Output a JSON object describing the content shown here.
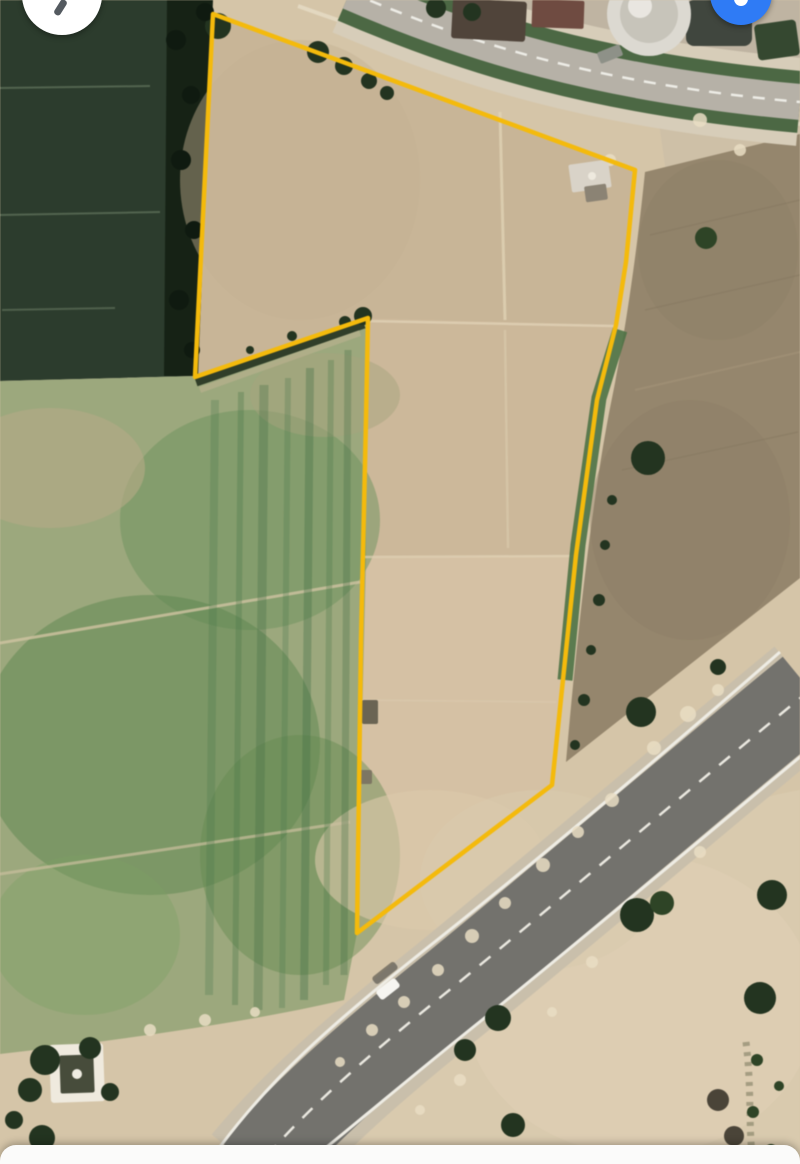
{
  "app": {
    "name": "satellite-map-parcel-view"
  },
  "controls": {
    "compass_button": {
      "bg": "#ffffff",
      "needle_color": "#545a60"
    },
    "location_button": {
      "bg": "#2f7bf5",
      "glyph_color": "#ffffff"
    },
    "bottom_sheet": {
      "bg": "#fbfbfa"
    }
  },
  "map": {
    "parcel": {
      "stroke": "#F4BA0C",
      "stroke_width": 4.5,
      "points": "213,14 635,170 626,262 616,325 597,400 576,555 552,785 357,933 361,640 366,420 368,318 195,377"
    },
    "highway": {
      "shoulder_color": "#c9bfab",
      "shoulder_width": 112,
      "asphalt_color": "#73726d",
      "asphalt_width": 86,
      "line_color": "#eeece4",
      "dash_color": "#eae8e0",
      "centerline_d": "M810,690 C700,780 566,895 452,988 C362,1060 300,1115 255,1170",
      "edge_upper_d": "M780,652 C670,748 536,862 422,952 C332,1024 268,1080 214,1155",
      "edge_lower_d": "M842,722 C730,815 596,928 482,1020 C392,1092 332,1144 298,1170"
    },
    "vehicle": {
      "cx": 388,
      "cy": 989,
      "w": 24,
      "h": 11,
      "angle": -38,
      "color": "#f6f5f1",
      "shadow_cx": 384,
      "shadow_cy": 975,
      "shadow_color": "#3c3c38"
    },
    "regions": [
      {
        "name": "base-sand",
        "d": "M0,0H800V1164H0Z",
        "fill": "#d5c5a8",
        "op": 1
      },
      {
        "name": "parcel-soil",
        "d": "M213,14L635,170L626,262L616,325L597,400L576,555L552,785L357,933L361,640L366,420L368,318L195,377Z",
        "fill": "#ccb89a",
        "op": 1
      },
      {
        "name": "parcel-top-block",
        "d": "M213,14L635,170L616,325L368,318L195,377Z",
        "fill": "#c7b496",
        "op": 0.85
      },
      {
        "name": "parcel-low-block",
        "d": "M363,558L576,555L552,785L357,933Z",
        "fill": "#d6c2a5",
        "op": 0.9
      },
      {
        "name": "dark-green-field",
        "d": "M0,0L207,0L196,376L0,381Z",
        "fill": "#2c3c2d",
        "op": 1
      },
      {
        "name": "tree-line",
        "d": "M167,0L213,0L198,376L164,376Z",
        "fill": "#162215",
        "op": 1
      },
      {
        "name": "left-farmland",
        "d": "M0,381L196,376L366,318L366,560L357,933L344,1000C250,1022 120,1040 0,1054Z",
        "fill": "#9ca87d",
        "op": 1
      },
      {
        "name": "buildings-zone",
        "d": "M390,0L800,0L800,90C640,72 510,38 390,0Z",
        "fill": "#bfb4a2",
        "op": 1
      },
      {
        "name": "right-sand-upper",
        "d": "M655,95L800,90L800,140L666,172Z",
        "fill": "#cec0a7",
        "op": 1
      },
      {
        "name": "brown-field",
        "d": "M645,172L800,134L800,578L566,762C580,600 596,478 611,403C623,345 636,262 645,172Z",
        "fill": "#95866d",
        "op": 1
      },
      {
        "name": "bottom-right-sand",
        "d": "M800,790L800,1164H330C420,1060 560,930 680,840C730,805 770,795 800,790Z",
        "fill": "#d9caae",
        "op": 1
      }
    ],
    "patches": [
      {
        "name": "farm-green-1",
        "cx": 250,
        "cy": 520,
        "rx": 130,
        "ry": 110,
        "fill": "#6c915d",
        "op": 0.5
      },
      {
        "name": "farm-green-2",
        "cx": 150,
        "cy": 745,
        "rx": 170,
        "ry": 150,
        "fill": "#5c864f",
        "op": 0.5
      },
      {
        "name": "farm-green-3",
        "cx": 300,
        "cy": 855,
        "rx": 100,
        "ry": 120,
        "fill": "#63894f",
        "op": 0.45
      },
      {
        "name": "farm-green-4",
        "cx": 85,
        "cy": 935,
        "rx": 95,
        "ry": 80,
        "fill": "#7da063",
        "op": 0.4
      },
      {
        "name": "farm-tan-1",
        "cx": 50,
        "cy": 468,
        "rx": 95,
        "ry": 60,
        "fill": "#b5aa87",
        "op": 0.6
      },
      {
        "name": "farm-tan-2",
        "cx": 325,
        "cy": 395,
        "rx": 75,
        "ry": 42,
        "fill": "#a5a47d",
        "op": 0.5
      },
      {
        "name": "parcel-gray-wash",
        "cx": 300,
        "cy": 180,
        "rx": 120,
        "ry": 140,
        "fill": "#c4b193",
        "op": 0.45
      },
      {
        "name": "parcel-light-wash",
        "cx": 430,
        "cy": 860,
        "rx": 115,
        "ry": 70,
        "fill": "#dccaab",
        "op": 0.6
      },
      {
        "name": "sand-light-1",
        "cx": 640,
        "cy": 1005,
        "rx": 175,
        "ry": 150,
        "fill": "#decfb4",
        "op": 0.7
      },
      {
        "name": "sand-light-2",
        "cx": 540,
        "cy": 880,
        "rx": 120,
        "ry": 90,
        "fill": "#d9c9ad",
        "op": 0.6
      },
      {
        "name": "brown-shade-1",
        "cx": 718,
        "cy": 250,
        "rx": 80,
        "ry": 90,
        "fill": "#8e8067",
        "op": 0.5
      },
      {
        "name": "brown-shade-2",
        "cx": 690,
        "cy": 520,
        "rx": 100,
        "ry": 120,
        "fill": "#8c7e66",
        "op": 0.4
      }
    ],
    "strokes": [
      {
        "name": "notch-shadow",
        "d": "M196,382L364,324",
        "stroke": "#1d2b1a",
        "w": 9,
        "op": 0.85
      },
      {
        "name": "notch-margin",
        "d": "M200,390L360,333",
        "stroke": "#c2b394",
        "w": 6,
        "op": 0.5
      },
      {
        "name": "farm-track-1",
        "d": "M0,643L360,582",
        "stroke": "#cfc3a1",
        "w": 3,
        "op": 0.8
      },
      {
        "name": "farm-track-2",
        "d": "M0,874L350,822",
        "stroke": "#cbbf9e",
        "w": 3,
        "op": 0.7
      },
      {
        "name": "farm-stripe-1",
        "d": "M215,400L209,995",
        "stroke": "#48764a",
        "w": 8,
        "op": 0.28
      },
      {
        "name": "farm-stripe-2",
        "d": "M241,392L235,1005",
        "stroke": "#48764a",
        "w": 6,
        "op": 0.33
      },
      {
        "name": "farm-stripe-3",
        "d": "M264,385L258,1010",
        "stroke": "#3f6b42",
        "w": 9,
        "op": 0.3
      },
      {
        "name": "farm-stripe-4",
        "d": "M288,378L282,1008",
        "stroke": "#48764a",
        "w": 6,
        "op": 0.28
      },
      {
        "name": "farm-stripe-5",
        "d": "M310,368L304,1000",
        "stroke": "#3f6b42",
        "w": 8,
        "op": 0.34
      },
      {
        "name": "farm-stripe-6",
        "d": "M331,360L326,985",
        "stroke": "#48764a",
        "w": 6,
        "op": 0.3
      },
      {
        "name": "farm-stripe-7",
        "d": "M348,350L344,975",
        "stroke": "#3f6b42",
        "w": 7,
        "op": 0.3
      },
      {
        "name": "darkfield-line-1",
        "d": "M0,88L150,86",
        "stroke": "#6d7e66",
        "w": 2,
        "op": 0.6
      },
      {
        "name": "darkfield-line-2",
        "d": "M0,215L160,212",
        "stroke": "#6d7e66",
        "w": 2,
        "op": 0.6
      },
      {
        "name": "darkfield-line-3",
        "d": "M2,310L115,308",
        "stroke": "#6d7e66",
        "w": 2,
        "op": 0.55
      },
      {
        "name": "parcel-div-1",
        "d": "M368,321L614,326",
        "stroke": "#e0d1b5",
        "w": 2.5,
        "op": 0.8
      },
      {
        "name": "parcel-div-2",
        "d": "M363,557L574,556",
        "stroke": "#e0d1b5",
        "w": 2.5,
        "op": 0.7
      },
      {
        "name": "parcel-div-3",
        "d": "M360,700L556,702",
        "stroke": "#dbcbaf",
        "w": 2,
        "op": 0.5
      },
      {
        "name": "parcel-track-v1",
        "d": "M500,112L505,320",
        "stroke": "#e3d5b8",
        "w": 3,
        "op": 0.7
      },
      {
        "name": "parcel-track-v2",
        "d": "M505,330L508,548",
        "stroke": "#decfb2",
        "w": 2.5,
        "op": 0.5
      },
      {
        "name": "brown-striation-1",
        "d": "M650,235L800,200",
        "stroke": "#857760",
        "w": 1.5,
        "op": 0.5
      },
      {
        "name": "brown-striation-2",
        "d": "M645,310L800,275",
        "stroke": "#857760",
        "w": 1.5,
        "op": 0.5
      },
      {
        "name": "brown-striation-3",
        "d": "M635,390L800,352",
        "stroke": "#a59479",
        "w": 2,
        "op": 0.6
      },
      {
        "name": "brown-striation-4",
        "d": "M622,470L798,432",
        "stroke": "#857760",
        "w": 1.5,
        "op": 0.5
      },
      {
        "name": "top-track-pale",
        "d": "M298,6C440,58 600,96 800,124",
        "stroke": "#e5dac4",
        "w": 4,
        "op": 0.85
      },
      {
        "name": "shrub-line-br",
        "d": "M746,1042C752,1090 748,1125 753,1164",
        "stroke": "#6e6e52",
        "w": 7,
        "op": 0.5,
        "dash": "4 6"
      },
      {
        "name": "road-green-upper",
        "d": "M350,-8 C470,44 600,84 800,102",
        "stroke": "#d7cdb9",
        "w": 88,
        "op": 1
      },
      {
        "name": "road-green",
        "d": "M350,-8 C470,44 600,84 800,102",
        "stroke": "#4c6844",
        "w": 62,
        "op": 1
      },
      {
        "name": "road-surface",
        "d": "M350,-8 C470,44 600,84 800,102",
        "stroke": "#b6b1a7",
        "w": 36,
        "op": 1
      },
      {
        "name": "road-dashes",
        "d": "M350,-8 C470,44 600,84 800,102",
        "stroke": "#f0efe9",
        "w": 2.5,
        "op": 0.95,
        "dash": "12 10"
      },
      {
        "name": "green-strip-parcel-right",
        "d": "M620,330L599,398L578,545L565,680",
        "stroke": "#4e7245",
        "w": 15,
        "op": 0.9
      }
    ],
    "speckles": [
      {
        "cx": 612,
        "cy": 800,
        "r": 7
      },
      {
        "cx": 578,
        "cy": 832,
        "r": 6
      },
      {
        "cx": 543,
        "cy": 865,
        "r": 7
      },
      {
        "cx": 505,
        "cy": 903,
        "r": 6
      },
      {
        "cx": 472,
        "cy": 936,
        "r": 7
      },
      {
        "cx": 438,
        "cy": 970,
        "r": 6
      },
      {
        "cx": 404,
        "cy": 1002,
        "r": 6
      },
      {
        "cx": 688,
        "cy": 714,
        "r": 8
      },
      {
        "cx": 718,
        "cy": 690,
        "r": 6
      },
      {
        "cx": 654,
        "cy": 748,
        "r": 7
      },
      {
        "cx": 372,
        "cy": 1030,
        "r": 6
      },
      {
        "cx": 340,
        "cy": 1062,
        "r": 5
      },
      {
        "cx": 700,
        "cy": 852,
        "r": 6
      },
      {
        "cx": 642,
        "cy": 907,
        "r": 5
      },
      {
        "cx": 592,
        "cy": 962,
        "r": 6
      },
      {
        "cx": 552,
        "cy": 1012,
        "r": 5
      },
      {
        "cx": 460,
        "cy": 1080,
        "r": 6
      },
      {
        "cx": 420,
        "cy": 1110,
        "r": 5
      },
      {
        "cx": 150,
        "cy": 1030,
        "r": 6
      },
      {
        "cx": 205,
        "cy": 1020,
        "r": 6
      },
      {
        "cx": 255,
        "cy": 1012,
        "r": 5
      },
      {
        "cx": 610,
        "cy": 160,
        "r": 6
      },
      {
        "cx": 700,
        "cy": 120,
        "r": 7
      },
      {
        "cx": 740,
        "cy": 150,
        "r": 6
      }
    ],
    "rects": [
      {
        "name": "roof-1",
        "x": 452,
        "y": 0,
        "w": 74,
        "h": 40,
        "rx": 3,
        "fill": "#50443a",
        "rot": 3
      },
      {
        "name": "roof-2",
        "x": 532,
        "y": 0,
        "w": 52,
        "h": 28,
        "rx": 2,
        "fill": "#6f4b41",
        "rot": 2
      },
      {
        "name": "storage-tank",
        "x": 686,
        "y": 0,
        "w": 66,
        "h": 46,
        "rx": 8,
        "fill": "#40463e",
        "rot": 0
      },
      {
        "name": "hedge-block",
        "x": 756,
        "y": 22,
        "w": 42,
        "h": 36,
        "rx": 4,
        "fill": "#354830",
        "rot": -8
      },
      {
        "name": "roadside-car",
        "x": 598,
        "y": 48,
        "w": 24,
        "h": 12,
        "rx": 2,
        "fill": "#8e9188",
        "rot": -22
      },
      {
        "name": "parcel-building",
        "x": 570,
        "y": 162,
        "w": 40,
        "h": 28,
        "rx": 2,
        "fill": "#d9d3c8",
        "rot": -8
      },
      {
        "name": "parcel-building-2",
        "x": 585,
        "y": 185,
        "w": 22,
        "h": 16,
        "rx": 2,
        "fill": "#8b8374",
        "rot": -8
      },
      {
        "name": "compound-wall",
        "x": 50,
        "y": 1044,
        "w": 54,
        "h": 58,
        "rx": 3,
        "fill": "#efeade",
        "rot": -2
      },
      {
        "name": "compound-court",
        "x": 60,
        "y": 1055,
        "w": 34,
        "h": 38,
        "rx": 2,
        "fill": "#474c3b",
        "rot": -2
      },
      {
        "name": "edge-structure-1",
        "x": 362,
        "y": 700,
        "w": 16,
        "h": 24,
        "rx": 2,
        "fill": "#6a6453",
        "rot": 0
      },
      {
        "name": "edge-structure-2",
        "x": 360,
        "y": 770,
        "w": 12,
        "h": 14,
        "rx": 2,
        "fill": "#7d7663",
        "rot": 0
      }
    ],
    "circles": [
      {
        "name": "silo-outer",
        "cx": 649,
        "cy": 14,
        "r": 42,
        "fill": "#dcd9d1",
        "op": 1
      },
      {
        "name": "silo-inner",
        "cx": 649,
        "cy": 14,
        "r": 29,
        "fill": "#c7c4ba",
        "op": 1
      },
      {
        "name": "silo-highlight",
        "cx": 640,
        "cy": 6,
        "r": 12,
        "fill": "#eceae4",
        "op": 0.9
      },
      {
        "name": "compound-dot",
        "cx": 77,
        "cy": 1074,
        "r": 5,
        "fill": "#efece2",
        "op": 1
      },
      {
        "name": "corner-white-dot",
        "cx": 592,
        "cy": 176,
        "r": 4,
        "fill": "#f0ebe0",
        "op": 0.9
      }
    ],
    "trees": [
      {
        "cx": 218,
        "cy": 26,
        "r": 13,
        "fill": "#233420"
      },
      {
        "cx": 318,
        "cy": 52,
        "r": 11,
        "fill": "#233420"
      },
      {
        "cx": 344,
        "cy": 66,
        "r": 9,
        "fill": "#233420"
      },
      {
        "cx": 369,
        "cy": 81,
        "r": 8,
        "fill": "#233420"
      },
      {
        "cx": 387,
        "cy": 93,
        "r": 7,
        "fill": "#233420"
      },
      {
        "cx": 436,
        "cy": 8,
        "r": 10,
        "fill": "#233420"
      },
      {
        "cx": 472,
        "cy": 12,
        "r": 9,
        "fill": "#233420"
      },
      {
        "cx": 363,
        "cy": 316,
        "r": 9,
        "fill": "#233420"
      },
      {
        "cx": 345,
        "cy": 322,
        "r": 6,
        "fill": "#233420"
      },
      {
        "cx": 292,
        "cy": 336,
        "r": 5,
        "fill": "#233420"
      },
      {
        "cx": 250,
        "cy": 350,
        "r": 4,
        "fill": "#233420"
      },
      {
        "cx": 706,
        "cy": 238,
        "r": 11,
        "fill": "#2e4426"
      },
      {
        "cx": 648,
        "cy": 458,
        "r": 17,
        "fill": "#233420"
      },
      {
        "cx": 641,
        "cy": 712,
        "r": 15,
        "fill": "#233420"
      },
      {
        "cx": 718,
        "cy": 667,
        "r": 8,
        "fill": "#233420"
      },
      {
        "cx": 612,
        "cy": 500,
        "r": 5,
        "fill": "#233420"
      },
      {
        "cx": 605,
        "cy": 545,
        "r": 5,
        "fill": "#233420"
      },
      {
        "cx": 599,
        "cy": 600,
        "r": 6,
        "fill": "#233420"
      },
      {
        "cx": 591,
        "cy": 650,
        "r": 5,
        "fill": "#233420"
      },
      {
        "cx": 584,
        "cy": 700,
        "r": 6,
        "fill": "#233420"
      },
      {
        "cx": 575,
        "cy": 745,
        "r": 5,
        "fill": "#233420"
      },
      {
        "cx": 637,
        "cy": 915,
        "r": 17,
        "fill": "#233420"
      },
      {
        "cx": 662,
        "cy": 903,
        "r": 12,
        "fill": "#2e4426"
      },
      {
        "cx": 772,
        "cy": 895,
        "r": 15,
        "fill": "#233420"
      },
      {
        "cx": 760,
        "cy": 998,
        "r": 16,
        "fill": "#233420"
      },
      {
        "cx": 498,
        "cy": 1018,
        "r": 13,
        "fill": "#233420"
      },
      {
        "cx": 465,
        "cy": 1050,
        "r": 11,
        "fill": "#233420"
      },
      {
        "cx": 513,
        "cy": 1125,
        "r": 12,
        "fill": "#233420"
      },
      {
        "cx": 45,
        "cy": 1060,
        "r": 15,
        "fill": "#233420"
      },
      {
        "cx": 90,
        "cy": 1048,
        "r": 11,
        "fill": "#233420"
      },
      {
        "cx": 30,
        "cy": 1090,
        "r": 12,
        "fill": "#233420"
      },
      {
        "cx": 110,
        "cy": 1092,
        "r": 9,
        "fill": "#233420"
      },
      {
        "cx": 42,
        "cy": 1138,
        "r": 13,
        "fill": "#233420"
      },
      {
        "cx": 14,
        "cy": 1120,
        "r": 9,
        "fill": "#233420"
      },
      {
        "cx": 718,
        "cy": 1100,
        "r": 11,
        "fill": "#4a4438"
      },
      {
        "cx": 734,
        "cy": 1136,
        "r": 10,
        "fill": "#4a4438"
      },
      {
        "cx": 706,
        "cy": 1156,
        "r": 8,
        "fill": "#4a4438"
      },
      {
        "cx": 757,
        "cy": 1060,
        "r": 6,
        "fill": "#2e4426"
      },
      {
        "cx": 779,
        "cy": 1086,
        "r": 5,
        "fill": "#2e4426"
      },
      {
        "cx": 753,
        "cy": 1112,
        "r": 6,
        "fill": "#2e4426"
      },
      {
        "cx": 771,
        "cy": 1150,
        "r": 6,
        "fill": "#2e4426"
      },
      {
        "cx": 176,
        "cy": 40,
        "r": 10,
        "fill": "#0f1a10"
      },
      {
        "cx": 191,
        "cy": 95,
        "r": 9,
        "fill": "#0f1a10"
      },
      {
        "cx": 181,
        "cy": 160,
        "r": 10,
        "fill": "#0f1a10"
      },
      {
        "cx": 194,
        "cy": 230,
        "r": 9,
        "fill": "#0f1a10"
      },
      {
        "cx": 179,
        "cy": 300,
        "r": 10,
        "fill": "#0f1a10"
      },
      {
        "cx": 192,
        "cy": 350,
        "r": 8,
        "fill": "#0f1a10"
      },
      {
        "cx": 205,
        "cy": 12,
        "r": 9,
        "fill": "#0f1a10"
      }
    ]
  }
}
